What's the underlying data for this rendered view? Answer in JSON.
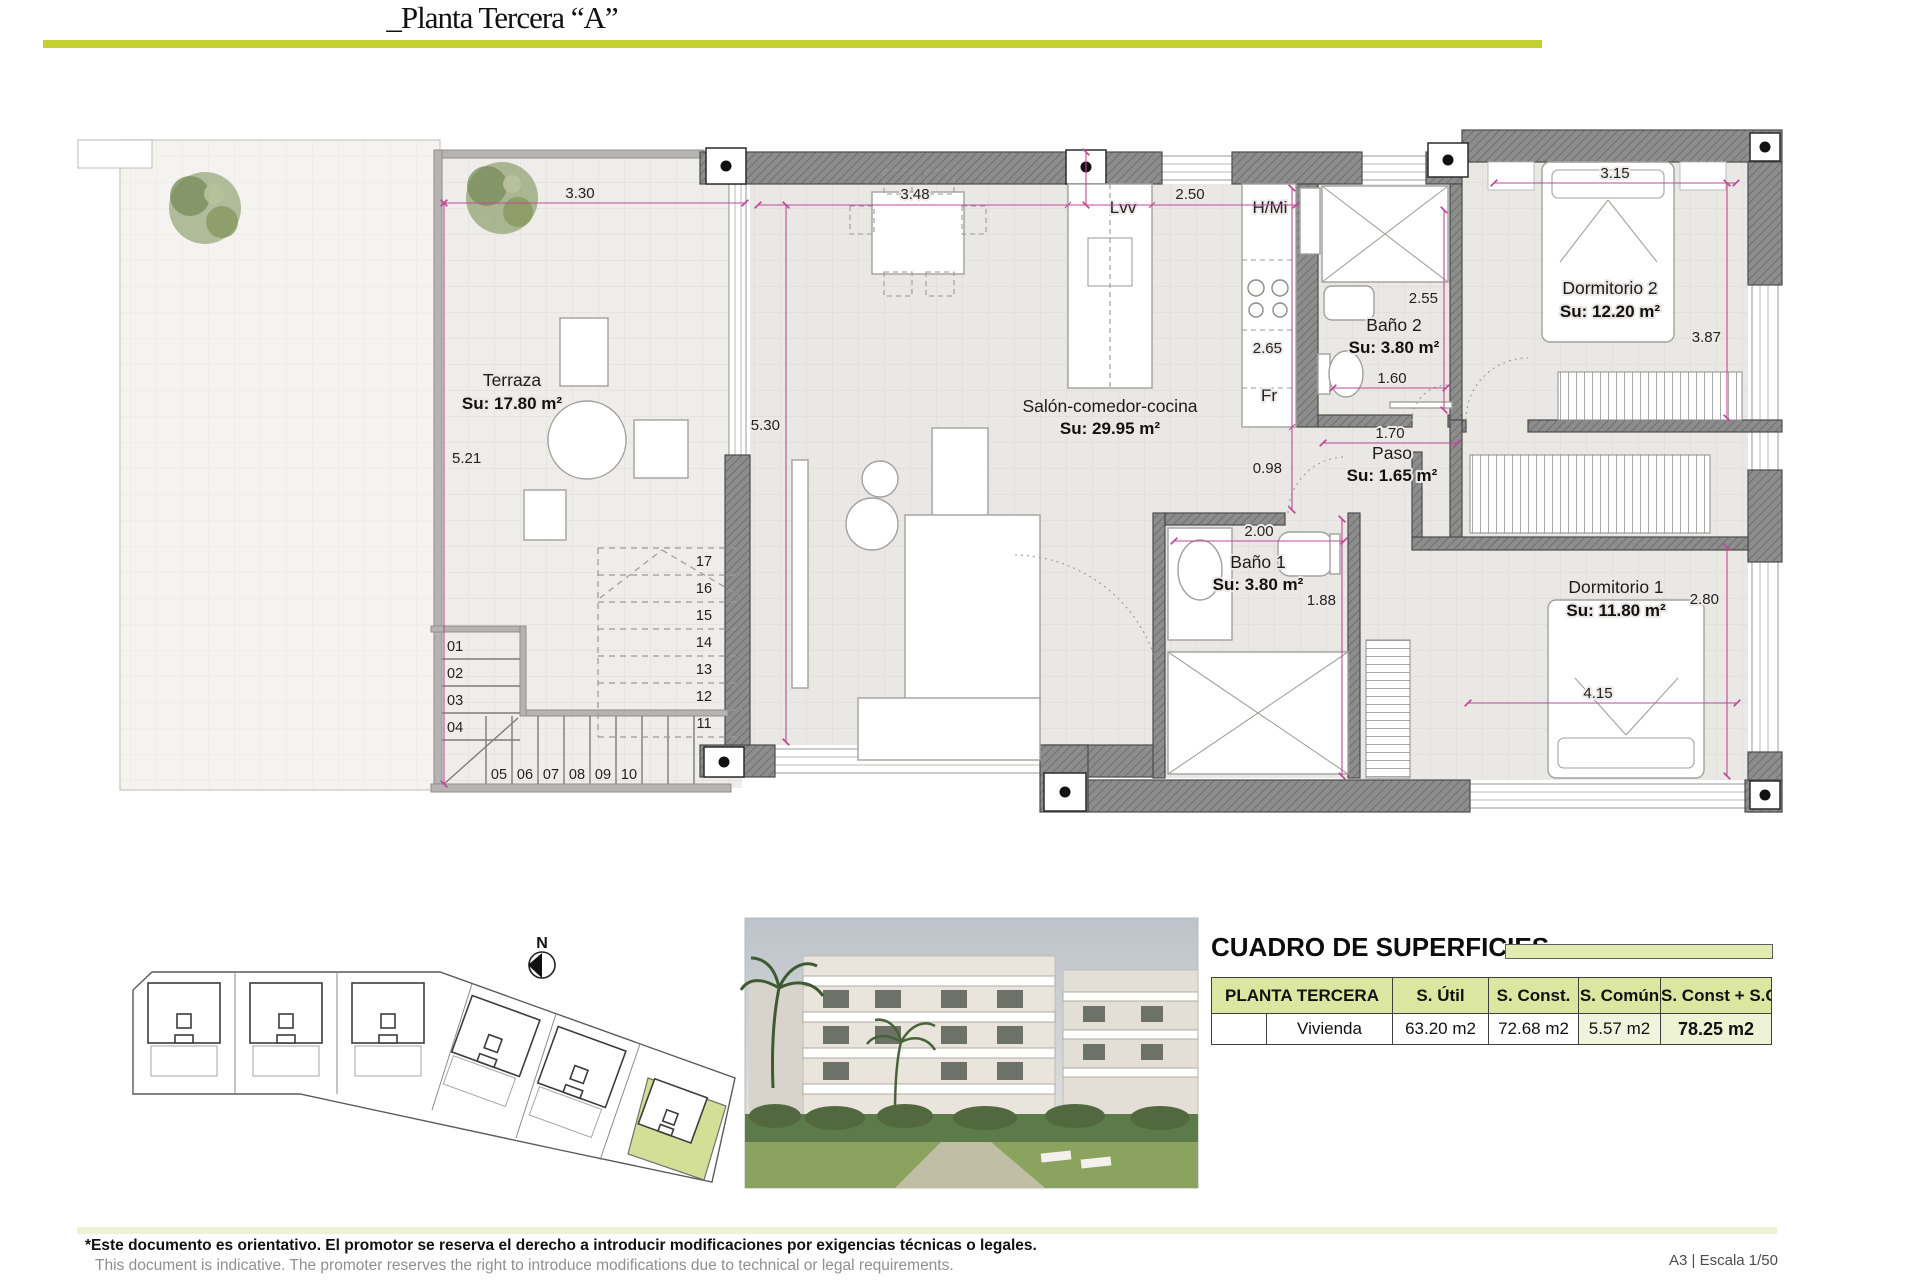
{
  "header": {
    "title": "_Planta Tercera “A”"
  },
  "plan": {
    "rooms": {
      "terraza": {
        "name": "Terraza",
        "area": "Su: 17.80 m²"
      },
      "salon": {
        "name": "Salón-comedor-cocina",
        "area": "Su: 29.95 m²"
      },
      "banyo2": {
        "name": "Baño 2",
        "area": "Su: 3.80 m²"
      },
      "dorm2": {
        "name": "Dormitorio 2",
        "area": "Su: 12.20 m²"
      },
      "paso": {
        "name": "Paso",
        "area": "Su: 1.65 m²"
      },
      "banyo1": {
        "name": "Baño 1",
        "area": "Su: 3.80 m²"
      },
      "dorm1": {
        "name": "Dormitorio 1",
        "area": "Su: 11.80 m²"
      }
    },
    "appliances": {
      "lvv": "Lvv",
      "hmi": "H/Mi",
      "fr": "Fr"
    },
    "dims": {
      "d330": "3.30",
      "d521": "5.21",
      "d348": "3.48",
      "d250": "2.50",
      "d530": "5.30",
      "d265": "2.65",
      "d098": "0.98",
      "d255": "2.55",
      "d160": "1.60",
      "d170": "1.70",
      "d200": "2.00",
      "d188": "1.88",
      "d315": "3.15",
      "d387": "3.87",
      "d280": "2.80",
      "d415": "4.15"
    },
    "stairs": {
      "left": [
        "01",
        "02",
        "03",
        "04"
      ],
      "bottom": [
        "05",
        "06",
        "07",
        "08",
        "09",
        "10"
      ],
      "upper": [
        "17",
        "16",
        "15",
        "14",
        "13",
        "12",
        "11"
      ]
    },
    "north_label": "N"
  },
  "surfaces": {
    "title": "CUADRO DE SUPERFICIES",
    "columns": [
      "PLANTA TERCERA",
      "S. Útil",
      "S. Const.",
      "S. Común",
      "S. Const + S.C"
    ],
    "rows": [
      {
        "label": "Vivienda",
        "util": "63.20 m2",
        "const": "72.68 m2",
        "comun": "5.57 m2",
        "total": "78.25 m2"
      }
    ]
  },
  "footer": {
    "disclaimer_es": "*Este documento es orientativo. El promotor se reserva el derecho a introducir modificaciones por exigencias técnicas o legales.",
    "disclaimer_en": "This document is indicative. The promoter reserves the right to introduce modifications due to technical or legal requirements.",
    "sheet_info": "A3 | Escala 1/50"
  },
  "colors": {
    "accent": "#c3d130",
    "accent_light": "#e2ebb0",
    "wall": "#8d8d8d",
    "dim_line": "#c04a96"
  }
}
